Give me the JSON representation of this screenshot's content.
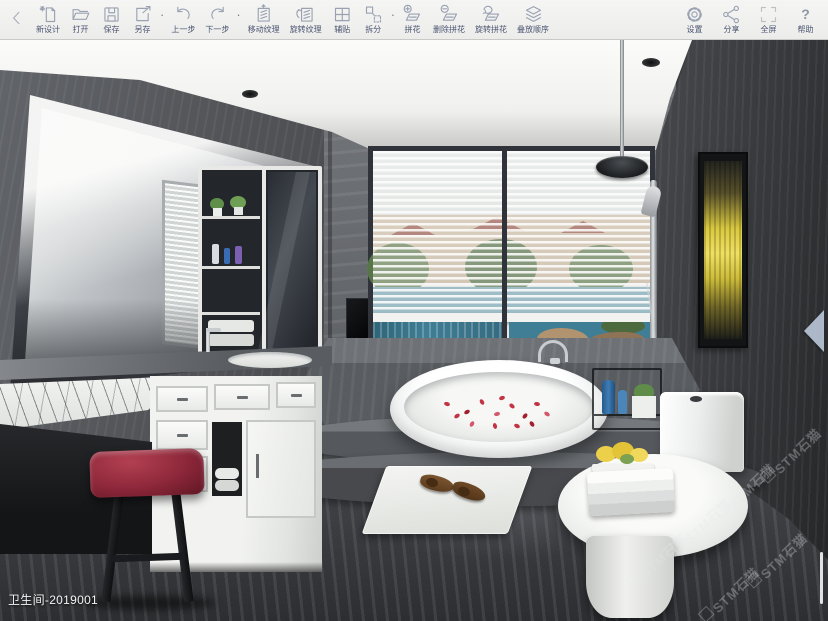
{
  "toolbar": {
    "separator": "·",
    "help_glyph": "?",
    "groups": [
      {
        "items": [
          {
            "id": "new-design",
            "label": "新设计"
          },
          {
            "id": "open",
            "label": "打开"
          },
          {
            "id": "save",
            "label": "保存"
          },
          {
            "id": "save-as",
            "label": "另存"
          }
        ]
      },
      {
        "items": [
          {
            "id": "undo",
            "label": "上一步"
          },
          {
            "id": "redo",
            "label": "下一步"
          }
        ]
      },
      {
        "items": [
          {
            "id": "move-texture",
            "label": "移动纹理"
          },
          {
            "id": "rotate-texture",
            "label": "旋转纹理"
          },
          {
            "id": "assist-tile",
            "label": "辅贴"
          },
          {
            "id": "split",
            "label": "拆分"
          }
        ]
      },
      {
        "items": [
          {
            "id": "mosaic",
            "label": "拼花"
          },
          {
            "id": "delete-mosaic",
            "label": "删除拼花"
          },
          {
            "id": "rotate-mosaic",
            "label": "旋转拼花"
          },
          {
            "id": "stack-order",
            "label": "叠放顺序"
          }
        ]
      }
    ],
    "right_items": [
      {
        "id": "settings",
        "label": "设置"
      },
      {
        "id": "share",
        "label": "分享"
      },
      {
        "id": "fullscreen",
        "label": "全屏"
      },
      {
        "id": "help",
        "label": "帮助"
      }
    ]
  },
  "canvas": {
    "project_label": "卫生间-2019001",
    "watermark_text": "STM石猫"
  },
  "colors": {
    "toolbar_bg": "#f1f1ef",
    "toolbar_label": "#4b5571",
    "icon_stroke": "#9aa2b2"
  }
}
